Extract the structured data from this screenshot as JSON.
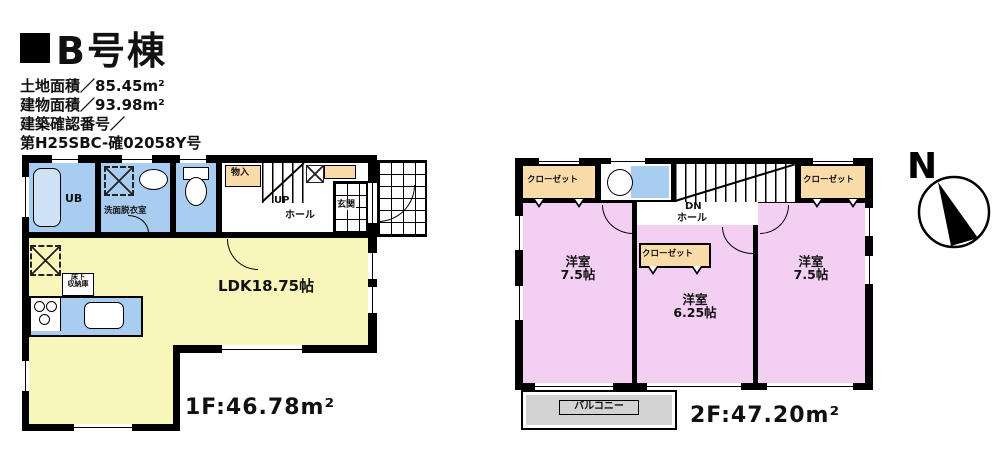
{
  "header": {
    "bullet": "■",
    "title": "B号棟",
    "lines": [
      "土地面積／85.45m²",
      "建物面積／93.98m²",
      "建築確認番号／",
      "第H25SBC-確02058Y号"
    ]
  },
  "floor1": {
    "area_label": "1F:46.78m²",
    "ldk": "LDK18.75帖",
    "ub": "UB",
    "washroom": "洗面脱衣室",
    "storage": "物入",
    "up": "UP",
    "hall": "ホール",
    "entrance": "玄関",
    "underfloor_line1": "床下",
    "underfloor_line2": "収納庫"
  },
  "floor2": {
    "area_label": "2F:47.20m²",
    "closet_left": "クローゼット",
    "closet_mid": "クローゼット",
    "closet_right": "クローゼット",
    "dn": "DN",
    "hall": "ホール",
    "room_left_name": "洋室",
    "room_left_size": "7.5帖",
    "room_mid_name": "洋室",
    "room_mid_size": "6.25帖",
    "room_right_name": "洋室",
    "room_right_size": "7.5帖",
    "balcony": "バルコニー"
  },
  "compass": {
    "north": "N"
  },
  "colors": {
    "ldk": "#f8f6bb",
    "wet_area": "#a9cdf0",
    "bedroom": "#f3d0f3",
    "closet": "#fadcaa",
    "balcony": "#d3d3d3",
    "wall": "#000000"
  }
}
